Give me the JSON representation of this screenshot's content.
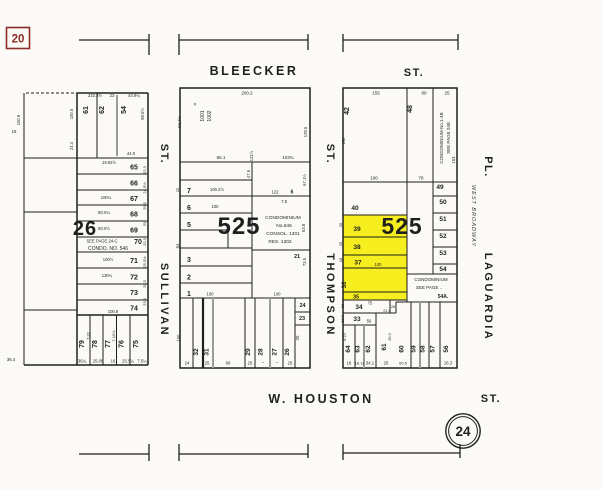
{
  "colors": {
    "background": "#fbfaf6",
    "ink": "#1f1f1f",
    "gray_line": "#9b9b9b",
    "highlight": "#f6ee1e",
    "page_ref_red": "#8d2c26"
  },
  "page_refs": {
    "adjacent_page": "20",
    "sheet_number": "24"
  },
  "streets": {
    "bleecker": {
      "name": "BLEECKER",
      "suffix": "ST."
    },
    "houston": {
      "name": "W. HOUSTON",
      "suffix": "ST."
    },
    "sullivan": {
      "name": "SULLIVAN",
      "suffix": "ST."
    },
    "thompson": {
      "name": "THOMPSON",
      "suffix": "ST."
    },
    "laguardia": {
      "name": "LAGUARDIA",
      "suffix": "PL.",
      "former_name": "WEST BROADWAY"
    }
  },
  "blocks": {
    "left": {
      "number": "26",
      "condo_note": "SEE PAGE 24-C",
      "condo_name": "CONDO. NO. 546"
    },
    "middle": {
      "number": "525",
      "condo": [
        "CONDOMINIUM",
        "No.646",
        "CONSOL. 1301",
        "RES. 1302"
      ]
    },
    "right": {
      "number": "525",
      "condo_strip": [
        "CONDOMINIUM-No.1-4B",
        "SEE PAGE 24B"
      ],
      "condo_lot": [
        "CONDOMINIUM",
        "SEE PAGE ..",
        "54A."
      ]
    }
  },
  "labels": {
    "left": [
      {
        "t": "210.3½",
        "x": 95,
        "y": 97,
        "s": 4.2
      },
      {
        "t": "23",
        "x": 112,
        "y": 97,
        "s": 4.2
      },
      {
        "t": "44.9¼",
        "x": 134,
        "y": 97,
        "s": 4.2
      },
      {
        "t": "98.0½",
        "x": 144,
        "y": 114,
        "r": -90,
        "s": 4.2
      },
      {
        "t": "100.5",
        "x": 73,
        "y": 114,
        "r": -90,
        "s": 4.2
      },
      {
        "t": "24.4",
        "x": 73,
        "y": 146,
        "r": -90,
        "s": 4.2
      },
      {
        "t": "61",
        "x": 88,
        "y": 110,
        "r": -90,
        "s": 7,
        "b": 1
      },
      {
        "t": "62",
        "x": 104,
        "y": 110,
        "r": -90,
        "s": 7,
        "b": 1
      },
      {
        "t": "54",
        "x": 126,
        "y": 110,
        "r": -90,
        "s": 7,
        "b": 1
      },
      {
        "t": "44.0",
        "x": 131,
        "y": 155,
        "s": 4.2
      },
      {
        "t": "65",
        "x": 134,
        "y": 169.5,
        "s": 7,
        "b": 1
      },
      {
        "t": "19.92½",
        "x": 109,
        "y": 164,
        "s": 4.2
      },
      {
        "t": "66",
        "x": 134,
        "y": 185.5,
        "s": 7,
        "b": 1
      },
      {
        "t": "67",
        "x": 134,
        "y": 201,
        "s": 7,
        "b": 1
      },
      {
        "t": "100¼",
        "x": 106,
        "y": 199,
        "s": 4.2
      },
      {
        "t": "68",
        "x": 134,
        "y": 216.5,
        "s": 7,
        "b": 1
      },
      {
        "t": "80.0¼",
        "x": 104,
        "y": 214,
        "s": 4.2
      },
      {
        "t": "69",
        "x": 134,
        "y": 232.5,
        "s": 7,
        "b": 1
      },
      {
        "t": "80.0½",
        "x": 104,
        "y": 230,
        "s": 4.2
      },
      {
        "t": "70",
        "x": 138,
        "y": 244,
        "s": 7,
        "b": 1
      },
      {
        "t": "71",
        "x": 134,
        "y": 263,
        "s": 7,
        "b": 1
      },
      {
        "t": "100½",
        "x": 108,
        "y": 261,
        "s": 4.2
      },
      {
        "t": "72",
        "x": 134,
        "y": 279.5,
        "s": 7,
        "b": 1
      },
      {
        "t": "130¼",
        "x": 107,
        "y": 277,
        "s": 4.2
      },
      {
        "t": "73",
        "x": 134,
        "y": 295,
        "s": 7,
        "b": 1
      },
      {
        "t": "74",
        "x": 134,
        "y": 310.5,
        "s": 7,
        "b": 1
      },
      {
        "t": "100.8",
        "x": 113,
        "y": 313,
        "s": 4.2
      },
      {
        "t": "22.3",
        "x": 146,
        "y": 170,
        "r": -90,
        "s": 4
      },
      {
        "t": "24.5½",
        "x": 146,
        "y": 188,
        "r": -90,
        "s": 4
      },
      {
        "t": "25.5",
        "x": 146,
        "y": 206,
        "r": -90,
        "s": 4
      },
      {
        "t": "23",
        "x": 146,
        "y": 224,
        "r": -90,
        "s": 4
      },
      {
        "t": "22.3",
        "x": 146,
        "y": 242,
        "r": -90,
        "s": 4
      },
      {
        "t": "25.5½",
        "x": 146,
        "y": 262,
        "r": -90,
        "s": 4
      },
      {
        "t": "25.5",
        "x": 146,
        "y": 284,
        "r": -90,
        "s": 4
      },
      {
        "t": "23.3",
        "x": 146,
        "y": 302,
        "r": -90,
        "s": 4
      },
      {
        "t": "79",
        "x": 84,
        "y": 344,
        "r": -90,
        "s": 7,
        "b": 1
      },
      {
        "t": "78",
        "x": 97,
        "y": 344,
        "r": -90,
        "s": 7,
        "b": 1
      },
      {
        "t": "77",
        "x": 110,
        "y": 344,
        "r": -90,
        "s": 7,
        "b": 1
      },
      {
        "t": "76",
        "x": 123.5,
        "y": 344,
        "r": -90,
        "s": 7,
        "b": 1
      },
      {
        "t": "75",
        "x": 138,
        "y": 344,
        "r": -90,
        "s": 7,
        "b": 1
      },
      {
        "t": "7.22",
        "x": 89.5,
        "y": 336,
        "r": -90,
        "s": 4
      },
      {
        "t": "7.19¾",
        "x": 115,
        "y": 336,
        "r": -90,
        "s": 4
      },
      {
        "t": "36¼",
        "x": 82,
        "y": 362.5,
        "s": 4.2
      },
      {
        "t": "25.08",
        "x": 98,
        "y": 362.5,
        "s": 4.2
      },
      {
        "t": "16",
        "x": 113,
        "y": 362.5,
        "s": 4.2
      },
      {
        "t": "25.5¼",
        "x": 128,
        "y": 362.5,
        "s": 4.2
      },
      {
        "t": "7.5¼",
        "x": 142,
        "y": 362.5,
        "s": 4.2
      },
      {
        "t": "19",
        "x": 14,
        "y": 133,
        "s": 4.2
      },
      {
        "t": "36.4",
        "x": 11,
        "y": 361,
        "s": 4.2
      },
      {
        "t": "100.9",
        "x": 20,
        "y": 120,
        "r": -90,
        "s": 4.2
      }
    ],
    "middle": [
      {
        "t": "200.2",
        "x": 247,
        "y": 94.5,
        "s": 4.5
      },
      {
        "t": "×",
        "x": 195,
        "y": 106,
        "s": 5
      },
      {
        "t": "1001",
        "x": 204,
        "y": 116,
        "r": -90,
        "s": 5
      },
      {
        "t": "1002",
        "x": 211,
        "y": 116,
        "r": -90,
        "s": 5
      },
      {
        "t": "92.4½",
        "x": 181,
        "y": 122,
        "r": -90,
        "s": 4.2
      },
      {
        "t": "65.1",
        "x": 221,
        "y": 159,
        "s": 4.5
      },
      {
        "t": "103¾",
        "x": 288,
        "y": 159,
        "s": 4.5
      },
      {
        "t": "121½",
        "x": 253,
        "y": 156,
        "r": -90,
        "s": 4.2
      },
      {
        "t": "129.5",
        "x": 307,
        "y": 132,
        "r": -90,
        "s": 4.2
      },
      {
        "t": "67.1½",
        "x": 306,
        "y": 180,
        "r": -90,
        "s": 4.2
      },
      {
        "t": "63.8",
        "x": 305,
        "y": 228,
        "r": -90,
        "s": 4.2
      },
      {
        "t": "73.5",
        "x": 306,
        "y": 262,
        "r": -90,
        "s": 4.2
      },
      {
        "t": "47.6",
        "x": 250,
        "y": 174,
        "r": -90,
        "s": 4.2
      },
      {
        "t": "7",
        "x": 189,
        "y": 193,
        "s": 7,
        "b": 1
      },
      {
        "t": "100.2½",
        "x": 217,
        "y": 191,
        "s": 4.2
      },
      {
        "t": "6",
        "x": 189,
        "y": 210,
        "s": 7,
        "b": 1
      },
      {
        "t": "100",
        "x": 215,
        "y": 208,
        "s": 4.2
      },
      {
        "t": "5",
        "x": 189,
        "y": 227,
        "s": 7,
        "b": 1
      },
      {
        "t": "122",
        "x": 275,
        "y": 193.5,
        "s": 4.2
      },
      {
        "t": "6",
        "x": 292,
        "y": 193.5,
        "s": 5,
        "b": 1
      },
      {
        "t": "7.8",
        "x": 284,
        "y": 203,
        "s": 4.2
      },
      {
        "t": "21",
        "x": 297,
        "y": 258,
        "s": 5.5,
        "b": 1
      },
      {
        "t": "3",
        "x": 189,
        "y": 262,
        "s": 7,
        "b": 1
      },
      {
        "t": "2",
        "x": 189,
        "y": 279.5,
        "s": 7,
        "b": 1
      },
      {
        "t": "1",
        "x": 189,
        "y": 296,
        "s": 7,
        "b": 1
      },
      {
        "t": "100",
        "x": 210,
        "y": 295.5,
        "s": 4.2
      },
      {
        "t": "100",
        "x": 277,
        "y": 295.5,
        "s": 4.2
      },
      {
        "t": "64",
        "x": 179,
        "y": 246,
        "r": -90,
        "s": 4.2
      },
      {
        "t": "100",
        "x": 180,
        "y": 338,
        "r": -90,
        "s": 4.2
      },
      {
        "t": "25",
        "x": 179,
        "y": 190,
        "r": -90,
        "s": 4
      },
      {
        "t": "32",
        "x": 198,
        "y": 352,
        "r": -90,
        "s": 6.5,
        "b": 1
      },
      {
        "t": "31",
        "x": 208.5,
        "y": 352,
        "r": -90,
        "s": 6.5,
        "b": 1
      },
      {
        "t": "29",
        "x": 250,
        "y": 352,
        "r": -90,
        "s": 6.5,
        "b": 1
      },
      {
        "t": "28",
        "x": 262.5,
        "y": 352,
        "r": -90,
        "s": 6.5,
        "b": 1
      },
      {
        "t": "27",
        "x": 276.5,
        "y": 352,
        "r": -90,
        "s": 6.5,
        "b": 1
      },
      {
        "t": "26",
        "x": 289,
        "y": 352,
        "r": -90,
        "s": 6.5,
        "b": 1
      },
      {
        "t": "24",
        "x": 302.5,
        "y": 307,
        "s": 5.5,
        "b": 1
      },
      {
        "t": "23",
        "x": 302,
        "y": 320,
        "s": 5.5,
        "b": 1
      },
      {
        "t": "25",
        "x": 299,
        "y": 338,
        "r": -90,
        "s": 4.5
      },
      {
        "t": "24",
        "x": 187,
        "y": 364.5,
        "s": 4.2
      },
      {
        "t": "25",
        "x": 207,
        "y": 364.5,
        "s": 4.2
      },
      {
        "t": "60",
        "x": 228,
        "y": 364.5,
        "s": 4.2
      },
      {
        "t": "25",
        "x": 250,
        "y": 364.5,
        "s": 4.2
      },
      {
        "t": "\"",
        "x": 263,
        "y": 365,
        "s": 4.5
      },
      {
        "t": "\"",
        "x": 277,
        "y": 365,
        "s": 4.5
      },
      {
        "t": "25",
        "x": 290,
        "y": 364.5,
        "s": 4.2
      }
    ],
    "right": [
      {
        "t": "155",
        "x": 376,
        "y": 94.5,
        "s": 4.5
      },
      {
        "t": "80",
        "x": 424,
        "y": 94.5,
        "s": 4.5
      },
      {
        "t": "25",
        "x": 447,
        "y": 94.5,
        "s": 4.5
      },
      {
        "t": "42",
        "x": 349,
        "y": 111,
        "r": -90,
        "s": 7,
        "b": 1
      },
      {
        "t": "48",
        "x": 412,
        "y": 109,
        "r": -90,
        "s": 7,
        "b": 1
      },
      {
        "t": "192",
        "x": 345,
        "y": 141,
        "r": -90,
        "s": 4.2
      },
      {
        "t": "163",
        "x": 455,
        "y": 160,
        "r": -90,
        "s": 4.2
      },
      {
        "t": "100",
        "x": 374,
        "y": 179.5,
        "s": 4.5
      },
      {
        "t": "78",
        "x": 421,
        "y": 179.5,
        "s": 4.5
      },
      {
        "t": "49",
        "x": 440,
        "y": 189,
        "s": 6.5,
        "b": 1
      },
      {
        "t": "50",
        "x": 443,
        "y": 204,
        "s": 6.5,
        "b": 1
      },
      {
        "t": "51",
        "x": 443,
        "y": 221,
        "s": 6.5,
        "b": 1
      },
      {
        "t": "52",
        "x": 443,
        "y": 238,
        "s": 6.5,
        "b": 1
      },
      {
        "t": "53",
        "x": 443,
        "y": 255,
        "s": 6.5,
        "b": 1
      },
      {
        "t": "54",
        "x": 443,
        "y": 271,
        "s": 6.5,
        "b": 1
      },
      {
        "t": "40",
        "x": 355,
        "y": 210,
        "s": 6.5,
        "b": 1
      },
      {
        "t": "39",
        "x": 357,
        "y": 231,
        "s": 6.5,
        "b": 1
      },
      {
        "t": "38",
        "x": 357,
        "y": 249,
        "s": 6.5,
        "b": 1
      },
      {
        "t": "37",
        "x": 358,
        "y": 264.5,
        "s": 6.5,
        "b": 1
      },
      {
        "t": "36",
        "x": 346,
        "y": 285,
        "r": -90,
        "s": 6,
        "b": 1
      },
      {
        "t": "35",
        "x": 356,
        "y": 298.5,
        "s": 5.5,
        "b": 1
      },
      {
        "t": "25",
        "x": 342,
        "y": 225,
        "r": -90,
        "s": 4
      },
      {
        "t": "25",
        "x": 342,
        "y": 244,
        "r": -90,
        "s": 4
      },
      {
        "t": "18",
        "x": 342,
        "y": 260,
        "r": -90,
        "s": 4
      },
      {
        "t": "100",
        "x": 378,
        "y": 266,
        "s": 4.2
      },
      {
        "t": "34",
        "x": 359,
        "y": 309,
        "s": 6.5,
        "b": 1
      },
      {
        "t": "75",
        "x": 370,
        "y": 304.5,
        "s": 4.2
      },
      {
        "t": "33",
        "x": 357,
        "y": 321,
        "s": 6.5,
        "b": 1
      },
      {
        "t": "56",
        "x": 369,
        "y": 322.5,
        "s": 4.2
      },
      {
        "t": "21.9",
        "x": 387,
        "y": 312,
        "s": 3.8
      },
      {
        "t": "26",
        "x": 393,
        "y": 308,
        "s": 3.8
      },
      {
        "t": "18",
        "x": 344,
        "y": 306,
        "r": -90,
        "s": 4
      },
      {
        "t": "18.3",
        "x": 344,
        "y": 319,
        "r": -90,
        "s": 4
      },
      {
        "t": "64",
        "x": 350,
        "y": 349,
        "r": -90,
        "s": 6.5,
        "b": 1
      },
      {
        "t": "63",
        "x": 359.5,
        "y": 349,
        "r": -90,
        "s": 6.5,
        "b": 1
      },
      {
        "t": "62",
        "x": 370,
        "y": 349,
        "r": -90,
        "s": 6.5,
        "b": 1
      },
      {
        "t": "61",
        "x": 386,
        "y": 347,
        "r": -90,
        "s": 6.5,
        "b": 1
      },
      {
        "t": "60",
        "x": 403.5,
        "y": 349,
        "r": -90,
        "s": 6.5,
        "b": 1
      },
      {
        "t": "59",
        "x": 415.5,
        "y": 349,
        "r": -90,
        "s": 6.5,
        "b": 1
      },
      {
        "t": "58",
        "x": 424.5,
        "y": 349,
        "r": -90,
        "s": 6.5,
        "b": 1
      },
      {
        "t": "57",
        "x": 434.5,
        "y": 349,
        "r": -90,
        "s": 6.5,
        "b": 1
      },
      {
        "t": "56",
        "x": 448,
        "y": 349,
        "r": -90,
        "s": 6.5,
        "b": 1
      },
      {
        "t": "6.10",
        "x": 346,
        "y": 337,
        "r": -90,
        "s": 3.8
      },
      {
        "t": "45.0",
        "x": 391,
        "y": 337,
        "r": -90,
        "s": 3.8
      },
      {
        "t": "18",
        "x": 349,
        "y": 364.5,
        "s": 4.2
      },
      {
        "t": "18.11",
        "x": 359.5,
        "y": 364.5,
        "s": 4
      },
      {
        "t": "34.1",
        "x": 370,
        "y": 364.5,
        "s": 4.2
      },
      {
        "t": "25",
        "x": 386,
        "y": 364.5,
        "s": 4.2
      },
      {
        "t": "60.5",
        "x": 403,
        "y": 364.5,
        "s": 4
      },
      {
        "t": "16.3",
        "x": 448,
        "y": 364.5,
        "s": 4.2
      }
    ]
  }
}
